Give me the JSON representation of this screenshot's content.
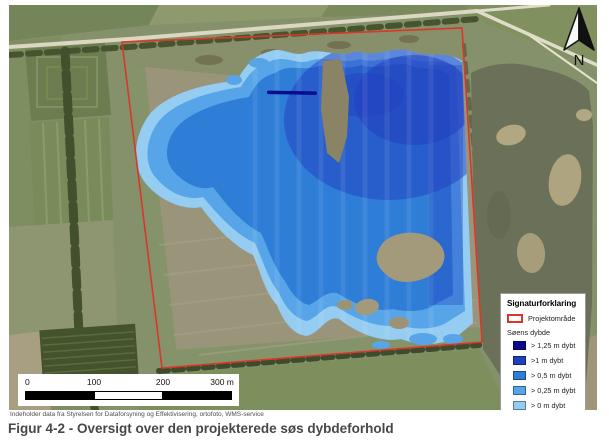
{
  "map": {
    "north_label": "N"
  },
  "scale_bar": {
    "ticks": [
      "0",
      "100",
      "200",
      "300 m"
    ]
  },
  "legend": {
    "title": "Signaturforklaring",
    "project_area": {
      "label": "Projektområde",
      "color": "#d9372a"
    },
    "depth_header": "Søens dybde",
    "depth_classes": [
      {
        "id": "d125",
        "label": "> 1,25 m dybt",
        "color": "#0a0b8f"
      },
      {
        "id": "d100",
        "label": ">1 m dybt",
        "color": "#2140c0"
      },
      {
        "id": "d050",
        "label": "> 0,5 m dybt",
        "color": "#2e7dd7"
      },
      {
        "id": "d025",
        "label": "> 0,25 m dybt",
        "color": "#57a5e8"
      },
      {
        "id": "d000",
        "label": "> 0 m dybt",
        "color": "#94ccf2"
      }
    ]
  },
  "attribution": "Indeholder data fra Styrelsen for Dataforsyning og Effektivisering, ortofoto, WMS-service",
  "caption": "Figur 4-2 - Oversigt over den projekterede søs dybdeforhold"
}
